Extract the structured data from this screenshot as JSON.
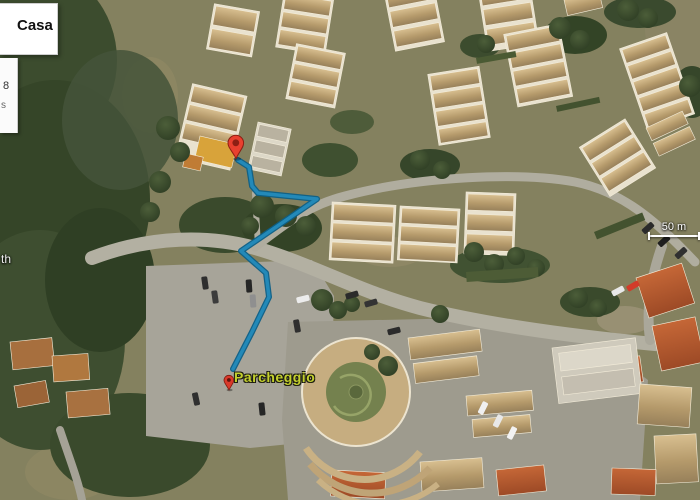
{
  "legend_panel": {
    "title": "Casa",
    "fragment_line1": "8",
    "fragment_line2": "s"
  },
  "map_labels": {
    "partial_left_label": "th",
    "parking_label": "Parcheggio",
    "scale_label": "50 m"
  },
  "route": {
    "points": "238,160 249,167 252,186 258,193 317,199 241,251 266,273 269,297 252,332 233,369",
    "color": "#2389b8",
    "casing_color": "#0d5f86"
  },
  "colors": {
    "marker_red": "#e8402f",
    "marker_red_dark": "#8d1f14",
    "parking_label_green": "#c3cf2e",
    "route_blue": "#2389b8",
    "panel_bg": "#ffffff"
  }
}
